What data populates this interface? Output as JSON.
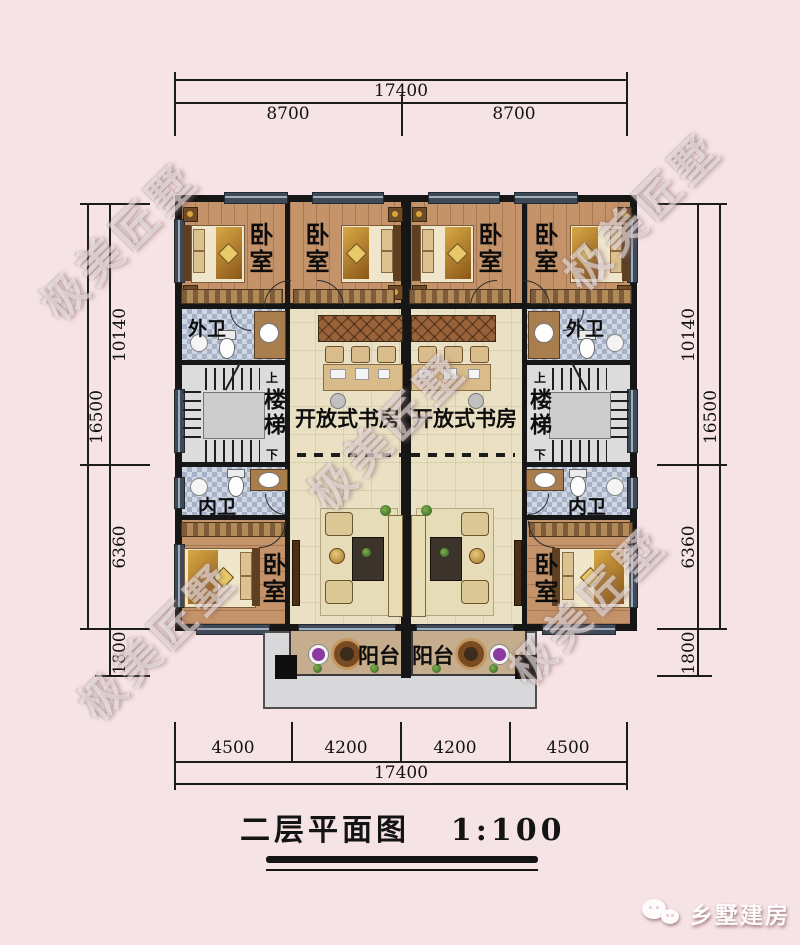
{
  "title": {
    "text": "二层平面图",
    "scale": "1:100"
  },
  "watermark": {
    "text": "极美匠墅"
  },
  "logo": {
    "brand": "乡墅建房",
    "icon": "wechat-icon"
  },
  "dimensions": {
    "top": {
      "total": "17400",
      "segments": [
        "8700",
        "8700"
      ]
    },
    "bottom": {
      "total": "17400",
      "segments": [
        "4500",
        "4200",
        "4200",
        "4500"
      ]
    },
    "left": {
      "overall": "16500",
      "upper": "10140",
      "lower": "6360",
      "balcony": "1800"
    },
    "right": {
      "overall": "16500",
      "upper": "10140",
      "lower": "6360",
      "balcony": "1800"
    }
  },
  "rooms": {
    "bedroom": "卧室",
    "outer_bath": "外卫",
    "inner_bath": "内卫",
    "stairs": "楼梯",
    "open_study": "开放式书房",
    "balcony": "阳台"
  },
  "stair_marks": {
    "up": "上",
    "down": "下"
  },
  "colors": {
    "background": "#f6e3e6",
    "wall": "#161616",
    "wood_floor": "#c4936a",
    "study_floor": "#eae1c4",
    "tile_floor": "#b9c3d6",
    "stair_floor": "#dcdcdc",
    "balcony_floor": "#c6ad8e",
    "window": "#3e4a58",
    "platform": "#d8d8da"
  }
}
